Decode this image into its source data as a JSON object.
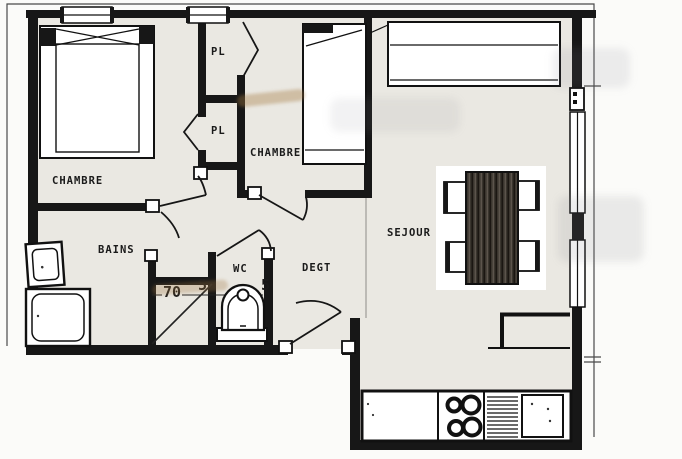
{
  "document": {
    "type": "apartment-floor-plan"
  },
  "rooms": {
    "chambre1": "CHAMBRE",
    "chambre2": "CHAMBRE",
    "sejour": "SEJOUR",
    "bains": "BAINS",
    "wc": "WC",
    "degagement": "DEGT",
    "closet_top": "PL",
    "closet_bottom": "PL"
  },
  "dimensions": {
    "shaft_width": "70",
    "wall_left": "5",
    "wall_right": "5"
  },
  "fixtures": [
    "double-bed",
    "single-bed",
    "closet-folding-doors",
    "sofa",
    "dining-table",
    "dining-chairs",
    "washbasin",
    "bathtub",
    "toilet",
    "kitchen-counter",
    "stove-burners",
    "sink-drainboard",
    "bar-counter",
    "windows",
    "glass-doors",
    "door-swings"
  ],
  "colors": {
    "wall": "#171717",
    "floor": "#eae8e2",
    "paper": "#fbfbf9"
  }
}
